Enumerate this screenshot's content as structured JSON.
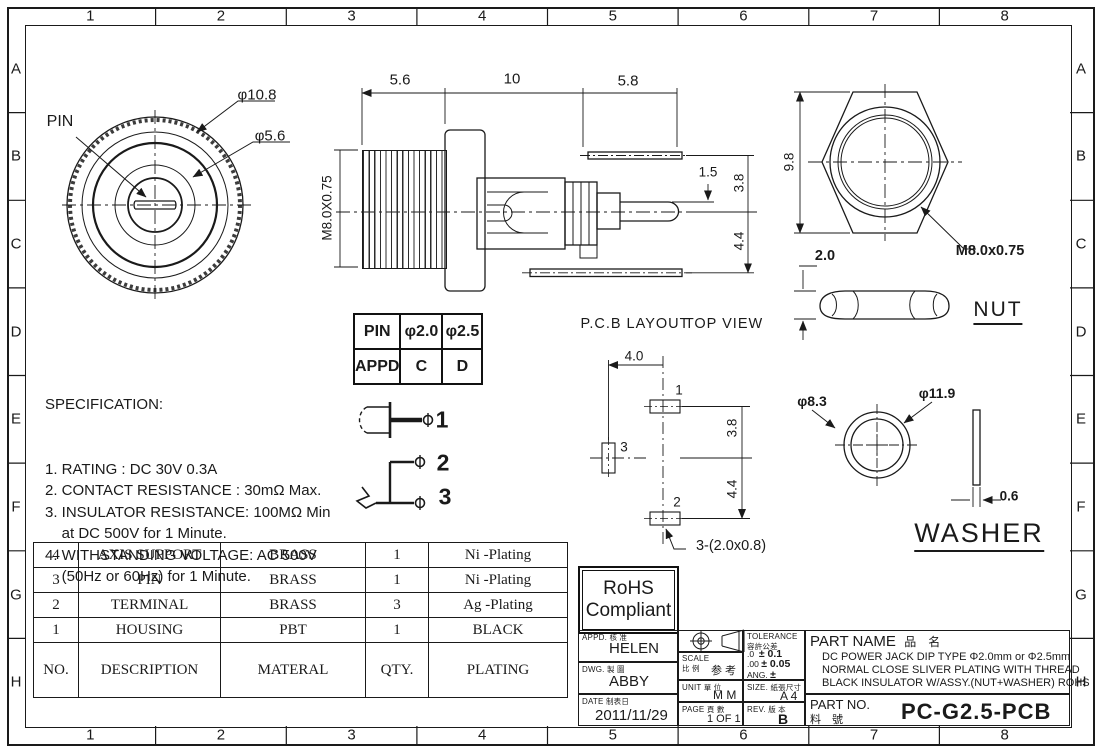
{
  "sheet": {
    "grid_columns": [
      "1",
      "2",
      "3",
      "4",
      "5",
      "6",
      "7",
      "8"
    ],
    "grid_rows": [
      "A",
      "B",
      "C",
      "D",
      "E",
      "F",
      "G",
      "H"
    ]
  },
  "labels": {
    "pin_callout": "PIN",
    "front_dia_outer": "φ10.8",
    "front_dia_inner": "φ5.6",
    "sec_dim_thread_len": "5.6",
    "sec_dim_body_len": "10",
    "sec_dim_lead_len": "5.8",
    "sec_dim_thread": "M8.0X0.75",
    "sec_dim_pin_offset": "1.5",
    "sec_dim_lead_top": "3.8",
    "sec_dim_lead_bottom": "4.4",
    "nut_dim_across": "9.8",
    "nut_thread": "M8.0x0.75",
    "nut_dim_thickness": "2.0",
    "nut_title": "NUT",
    "pcb_title": "P.C.B LAYOUT",
    "pcb_subtitle": "TOP VIEW",
    "pcb_dim_h": "4.0",
    "pcb_pad1": "1",
    "pcb_pad3": "3",
    "pcb_pad2": "2",
    "pcb_dim_v1": "3.8",
    "pcb_dim_v2": "4.4",
    "pcb_pad_note": "3-(2.0x0.8)",
    "washer_dia_inner": "φ8.3",
    "washer_dia_outer": "φ11.9",
    "washer_dim_thickness": "0.6",
    "washer_title": "WASHER",
    "pin_sym_1": "1",
    "pin_sym_2": "2",
    "pin_sym_3": "3"
  },
  "specification": {
    "title": "SPECIFICATION:",
    "lines": [
      "1. RATING : DC 30V 0.3A",
      "2. CONTACT RESISTANCE : 30mΩ Max.",
      "3. INSULATOR RESISTANCE: 100MΩ Min",
      "    at DC 500V for 1 Minute.",
      "4. WITHSTANDING VOLTAGE: AC 500V",
      "    (50Hz or 60Hz) for 1 Minute."
    ]
  },
  "pin_table": {
    "rows": [
      [
        "PIN",
        "φ2.0",
        "φ2.5"
      ],
      [
        "APPD",
        "C",
        "D"
      ]
    ]
  },
  "parts_table": {
    "data_rows": [
      [
        "4",
        "AXIS SUPPORT",
        "BRASS",
        "1",
        "Ni -Plating"
      ],
      [
        "3",
        "PIN",
        "BRASS",
        "1",
        "Ni -Plating"
      ],
      [
        "2",
        "TERMINAL",
        "BRASS",
        "3",
        "Ag -Plating"
      ],
      [
        "1",
        "HOUSING",
        "PBT",
        "1",
        "BLACK"
      ]
    ],
    "header_row": [
      "NO.",
      "DESCRIPTION",
      "MATERAL",
      "QTY.",
      "PLATING"
    ]
  },
  "rohs": {
    "line1": "RoHS",
    "line2": "Compliant"
  },
  "title_block": {
    "appd_label": "APPD.",
    "appd_cn": "核 准",
    "appd_value": "HELEN",
    "dwg_label": "DWG.",
    "dwg_cn": "製 圖",
    "dwg_value": "ABBY",
    "date_label": "DATE",
    "date_cn": "制表日",
    "date_value": "2011/11/29",
    "scale_label": "SCALE",
    "scale_cn": "比 例",
    "scale_value": "参 考",
    "unit_label": "UNIT",
    "unit_cn": "單 位",
    "unit_value": "M M",
    "page_label": "PAGE",
    "page_cn": "頁 數",
    "page_value": "1 OF 1",
    "tol_label": "TOLERANCE",
    "tol_cn": "容許公差",
    "tol_row1_key": ".0",
    "tol_row1_val": "± 0.1",
    "tol_row2_key": ".00",
    "tol_row2_val": "± 0.05",
    "tol_row3_key": "ANG.",
    "tol_row3_val": "±",
    "size_label": "SIZE.",
    "size_cn": "紙張尺寸",
    "size_value": "A 4",
    "rev_label": "REV.",
    "rev_cn": "版 本",
    "rev_value": "B",
    "part_name_label": "PART NAME",
    "part_name_cn": "品　名",
    "part_desc_line1": "DC POWER JACK DIP TYPE Φ2.0mm or Φ2.5mm",
    "part_desc_line2": "NORMAL CLOSE SLIVER PLATING WITH THREAD",
    "part_desc_line3": "BLACK INSULATOR W/ASSY.(NUT+WASHER) ROHS",
    "part_no_label": "PART NO.",
    "part_no_cn": "料　號",
    "part_no_value": "PC-G2.5-PCB"
  }
}
